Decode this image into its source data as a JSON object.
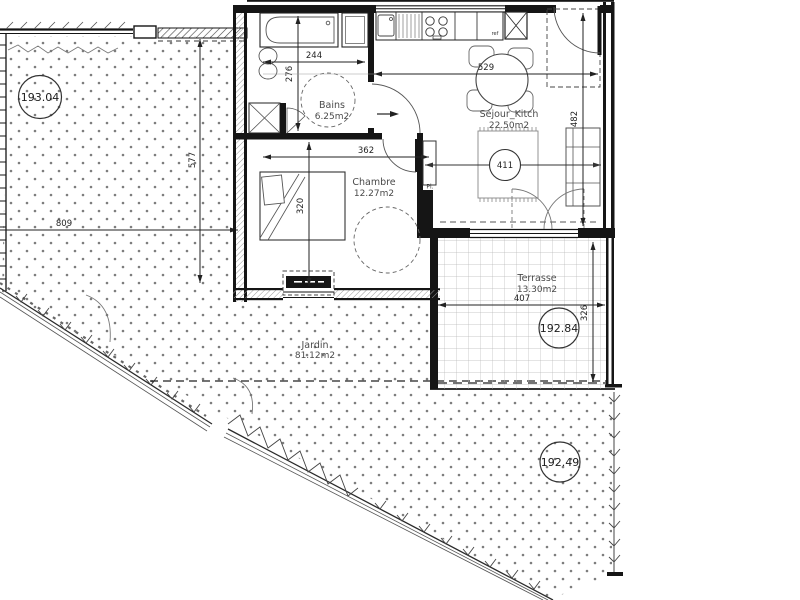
{
  "plan": {
    "rooms": {
      "bains": {
        "name": "Bains",
        "area": "6.25m2"
      },
      "sejour": {
        "name": "Séjour_Kitch",
        "area": "22.50m2"
      },
      "chambre": {
        "name": "Chambre",
        "area": "12.27m2"
      },
      "terrasse": {
        "name": "Terrasse",
        "area": "13.30m2"
      },
      "jardin": {
        "name": "Jardin",
        "area": "81.12m2"
      }
    },
    "dims": {
      "d244": "244",
      "d276": "276",
      "d529": "529",
      "d482": "482",
      "d362": "362",
      "d320": "320",
      "d577": "577",
      "d809": "809",
      "d407": "407",
      "d326": "326",
      "d411": "411"
    },
    "levels": {
      "l19304": "193.04",
      "l19284": "192.84",
      "l19249": "192.49"
    },
    "notes": {
      "ref": "ref",
      "pl": "Pl."
    },
    "colors": {
      "line": "#151515",
      "mid": "#555555",
      "dots": "#7d7d7d"
    }
  }
}
